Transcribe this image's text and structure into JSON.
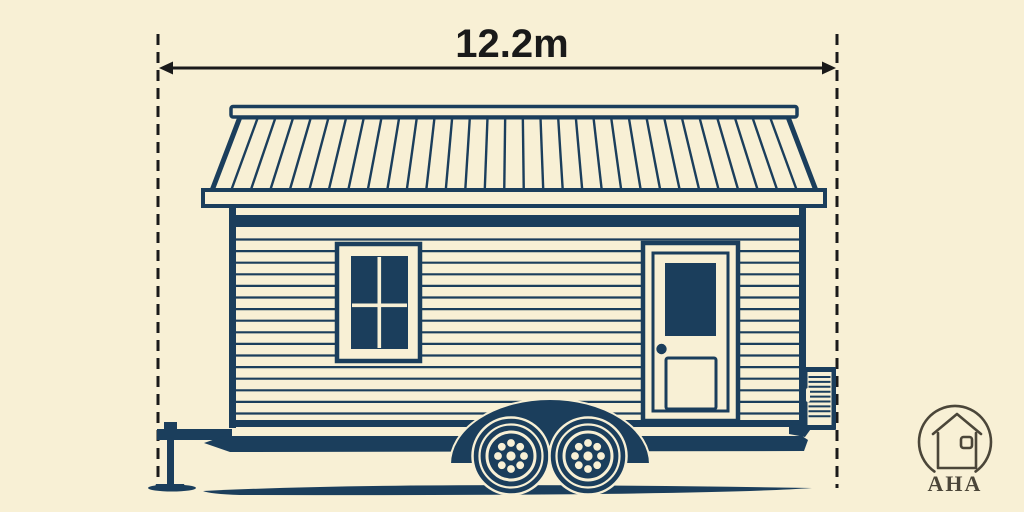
{
  "dimension": {
    "label": "12.2m",
    "value": 12.2,
    "unit": "m"
  },
  "logo": {
    "text": "AHA",
    "icon": "house-in-circle-icon"
  },
  "illustration": {
    "subject": "tiny-house-on-wheels"
  },
  "colors": {
    "bg": "#f8f0d5",
    "ink": "#1b3e5c",
    "line": "#1a1a1a",
    "logo": "#4b4639"
  }
}
